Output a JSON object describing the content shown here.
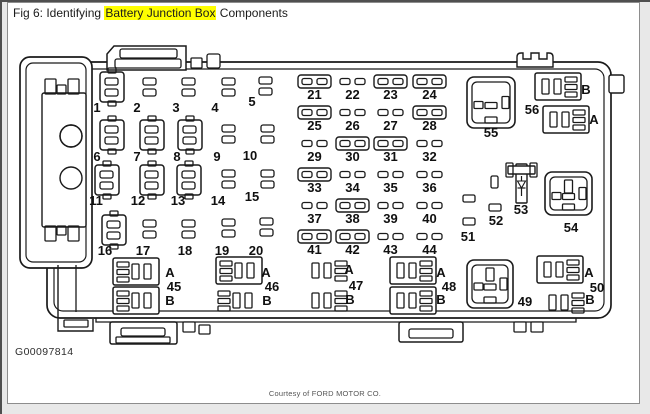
{
  "window": {
    "title_prefix": "Fig 6: Identifying ",
    "title_highlight": "Battery Junction Box",
    "title_suffix": " Components",
    "highlight_color": "#ffff00"
  },
  "footer": {
    "figure_id": "G00097814",
    "credit": "Courtesy of FORD MOTOR CO."
  },
  "diagram": {
    "stroke_color": "#1a1a1a",
    "holders": [
      {
        "id": "1",
        "x": 100,
        "y": 72,
        "lx": 97,
        "ly": 112
      },
      {
        "id": "6",
        "x": 100,
        "y": 120,
        "lx": 97,
        "ly": 161
      },
      {
        "id": "7",
        "x": 140,
        "y": 120,
        "lx": 137,
        "ly": 161
      },
      {
        "id": "8",
        "x": 178,
        "y": 120,
        "lx": 177,
        "ly": 161
      },
      {
        "id": "11",
        "x": 95,
        "y": 165,
        "lx": 96,
        "ly": 205
      },
      {
        "id": "12",
        "x": 140,
        "y": 165,
        "lx": 138,
        "ly": 205
      },
      {
        "id": "13",
        "x": 177,
        "y": 165,
        "lx": 178,
        "ly": 205
      },
      {
        "id": "16",
        "x": 102,
        "y": 215,
        "lx": 105,
        "ly": 255
      }
    ],
    "slot_pairs": [
      {
        "id": "2",
        "x": 143,
        "y": 78,
        "lx": 137,
        "ly": 112
      },
      {
        "id": "3",
        "x": 182,
        "y": 78,
        "lx": 176,
        "ly": 112
      },
      {
        "id": "4",
        "x": 222,
        "y": 78,
        "lx": 215,
        "ly": 112
      },
      {
        "id": "5",
        "x": 259,
        "y": 77,
        "lx": 252,
        "ly": 106
      },
      {
        "id": "9",
        "x": 222,
        "y": 125,
        "lx": 217,
        "ly": 161
      },
      {
        "id": "10",
        "x": 261,
        "y": 125,
        "lx": 250,
        "ly": 160
      },
      {
        "id": "14",
        "x": 222,
        "y": 170,
        "lx": 218,
        "ly": 205
      },
      {
        "id": "15",
        "x": 261,
        "y": 170,
        "lx": 252,
        "ly": 201
      },
      {
        "id": "17",
        "x": 143,
        "y": 220,
        "lx": 143,
        "ly": 255
      },
      {
        "id": "18",
        "x": 182,
        "y": 220,
        "lx": 185,
        "ly": 255
      },
      {
        "id": "19",
        "x": 222,
        "y": 219,
        "lx": 222,
        "ly": 255
      },
      {
        "id": "20",
        "x": 260,
        "y": 218,
        "lx": 256,
        "ly": 255
      }
    ],
    "mini_grid": {
      "cols": [
        298,
        336,
        374,
        413
      ],
      "rows": [
        75,
        106,
        137,
        168,
        199,
        230
      ]
    },
    "mini_fuses": [
      {
        "id": "21",
        "col": 0,
        "row": 0,
        "boxed": true
      },
      {
        "id": "22",
        "col": 1,
        "row": 0,
        "boxed": false
      },
      {
        "id": "23",
        "col": 2,
        "row": 0,
        "boxed": true
      },
      {
        "id": "24",
        "col": 3,
        "row": 0,
        "boxed": true
      },
      {
        "id": "25",
        "col": 0,
        "row": 1,
        "boxed": true
      },
      {
        "id": "26",
        "col": 1,
        "row": 1,
        "boxed": false
      },
      {
        "id": "27",
        "col": 2,
        "row": 1,
        "boxed": false
      },
      {
        "id": "28",
        "col": 3,
        "row": 1,
        "boxed": true
      },
      {
        "id": "29",
        "col": 0,
        "row": 2,
        "boxed": false
      },
      {
        "id": "30",
        "col": 1,
        "row": 2,
        "boxed": true
      },
      {
        "id": "31",
        "col": 2,
        "row": 2,
        "boxed": true
      },
      {
        "id": "32",
        "col": 3,
        "row": 2,
        "boxed": false
      },
      {
        "id": "33",
        "col": 0,
        "row": 3,
        "boxed": true
      },
      {
        "id": "34",
        "col": 1,
        "row": 3,
        "boxed": false
      },
      {
        "id": "35",
        "col": 2,
        "row": 3,
        "boxed": false
      },
      {
        "id": "36",
        "col": 3,
        "row": 3,
        "boxed": false
      },
      {
        "id": "37",
        "col": 0,
        "row": 4,
        "boxed": false
      },
      {
        "id": "38",
        "col": 1,
        "row": 4,
        "boxed": true
      },
      {
        "id": "39",
        "col": 2,
        "row": 4,
        "boxed": false
      },
      {
        "id": "40",
        "col": 3,
        "row": 4,
        "boxed": false
      },
      {
        "id": "41",
        "col": 0,
        "row": 5,
        "boxed": true
      },
      {
        "id": "42",
        "col": 1,
        "row": 5,
        "boxed": true
      },
      {
        "id": "43",
        "col": 2,
        "row": 5,
        "boxed": false
      },
      {
        "id": "44",
        "col": 3,
        "row": 5,
        "boxed": false
      }
    ],
    "connectors": [
      {
        "id": "45",
        "nx": 174,
        "ny": 291,
        "groups": [
          {
            "label": "A",
            "x": 113,
            "y": 258,
            "boxed": true,
            "mirror": false,
            "lx": 170,
            "ly": 277
          },
          {
            "label": "B",
            "x": 113,
            "y": 287,
            "boxed": true,
            "mirror": false,
            "lx": 170,
            "ly": 305
          }
        ]
      },
      {
        "id": "46",
        "nx": 272,
        "ny": 291,
        "groups": [
          {
            "label": "A",
            "x": 216,
            "y": 257,
            "boxed": true,
            "mirror": false,
            "lx": 266,
            "ly": 277
          },
          {
            "label": "B",
            "x": 214,
            "y": 287,
            "boxed": false,
            "mirror": false,
            "lx": 267,
            "ly": 305
          }
        ]
      },
      {
        "id": "47",
        "nx": 356,
        "ny": 290,
        "groups": [
          {
            "label": "A",
            "x": 305,
            "y": 257,
            "boxed": false,
            "mirror": true,
            "lx": 349,
            "ly": 274
          },
          {
            "label": "B",
            "x": 305,
            "y": 287,
            "boxed": false,
            "mirror": true,
            "lx": 350,
            "ly": 304
          }
        ]
      },
      {
        "id": "48",
        "nx": 449,
        "ny": 291,
        "groups": [
          {
            "label": "A",
            "x": 390,
            "y": 257,
            "boxed": true,
            "mirror": true,
            "lx": 441,
            "ly": 277
          },
          {
            "label": "B",
            "x": 390,
            "y": 287,
            "boxed": true,
            "mirror": true,
            "lx": 441,
            "ly": 304
          }
        ]
      },
      {
        "id": "50",
        "nx": 597,
        "ny": 292,
        "groups": [
          {
            "label": "A",
            "x": 537,
            "y": 256,
            "boxed": true,
            "mirror": true,
            "lx": 589,
            "ly": 277
          },
          {
            "label": "B",
            "x": 542,
            "y": 289,
            "boxed": false,
            "mirror": true,
            "lx": 590,
            "ly": 304
          }
        ]
      },
      {
        "id": "56",
        "nx": 532,
        "ny": 114,
        "groups": [
          {
            "label": "B",
            "x": 535,
            "y": 73,
            "boxed": true,
            "mirror": true,
            "lx": 586,
            "ly": 94
          },
          {
            "label": "A",
            "x": 543,
            "y": 106,
            "boxed": true,
            "mirror": true,
            "lx": 594,
            "ly": 124
          }
        ]
      }
    ],
    "power_relays": [
      {
        "id": "55",
        "x": 467,
        "y": 77,
        "w": 48,
        "h": 51,
        "top_pin": false,
        "lx": 491,
        "ly": 137
      },
      {
        "id": "54",
        "x": 545,
        "y": 172,
        "w": 47,
        "h": 43,
        "top_pin": true,
        "lx": 571,
        "ly": 232
      },
      {
        "id": "49",
        "x": 467,
        "y": 260,
        "w": 46,
        "h": 48,
        "top_pin": true,
        "lx": 525,
        "ly": 306
      }
    ],
    "diode": {
      "id": "53",
      "x": 508,
      "y": 163,
      "lx": 521,
      "ly": 214
    },
    "misc_slots": [
      {
        "id": "51",
        "slots": [
          [
            463,
            195,
            12,
            7
          ],
          [
            463,
            218,
            12,
            7
          ]
        ],
        "lx": 468,
        "ly": 241
      },
      {
        "id": "52",
        "slots": [
          [
            491,
            176,
            7,
            12
          ],
          [
            489,
            204,
            12,
            7
          ]
        ],
        "lx": 496,
        "ly": 225
      }
    ]
  }
}
